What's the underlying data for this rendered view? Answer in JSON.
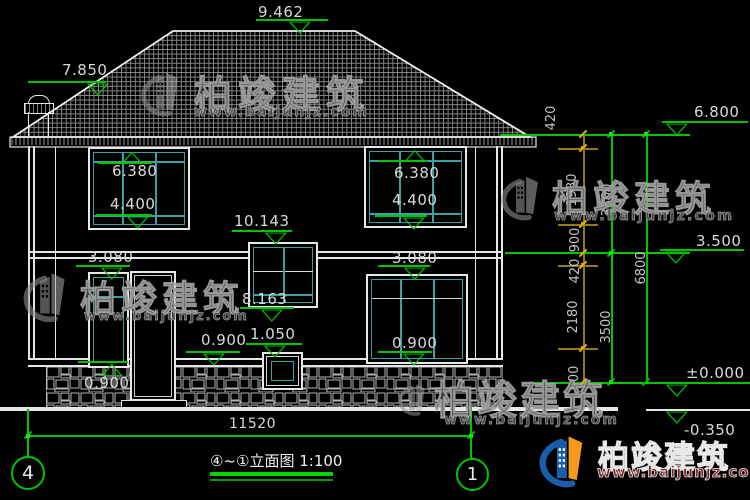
{
  "drawing": {
    "title": "④~①立面图 1:100",
    "grid_left": "4",
    "grid_right": "1",
    "overall_width": "11520"
  },
  "levels": {
    "ridge": "9.462",
    "chimney_top": "7.850",
    "eave": "6.800",
    "floor2": "3.500",
    "ground_zero": "±0.000",
    "site": "-0.350",
    "win2f_left_head": "6.380",
    "win2f_left_sill": "4.400",
    "win2f_right_head": "6.380",
    "win2f_right_sill": "4.400",
    "stair_win_head": "10.143",
    "stair_win_sill": "8.163",
    "win1f_left_head": "3.080",
    "win1f_right_head": "3.080",
    "win1f_left_sill": "0.900",
    "win1f_mid_sill": "0.900",
    "win1f_right_sill": "0.900",
    "small_win_head": "1.050"
  },
  "dim_chains": {
    "inner": [
      "420",
      "1980",
      "900",
      "420",
      "2180",
      "900"
    ],
    "middle": [
      "3300",
      "3500"
    ],
    "outer": [
      "6800"
    ]
  },
  "watermark": {
    "brand": "柏竣建筑",
    "url": "www.baijunjz.com"
  },
  "colors": {
    "annotation_green": "#00c400",
    "glazing_teal": "#3aa0a0",
    "dim_yellow": "#ecb300",
    "line_white": "#e6e6e6"
  }
}
